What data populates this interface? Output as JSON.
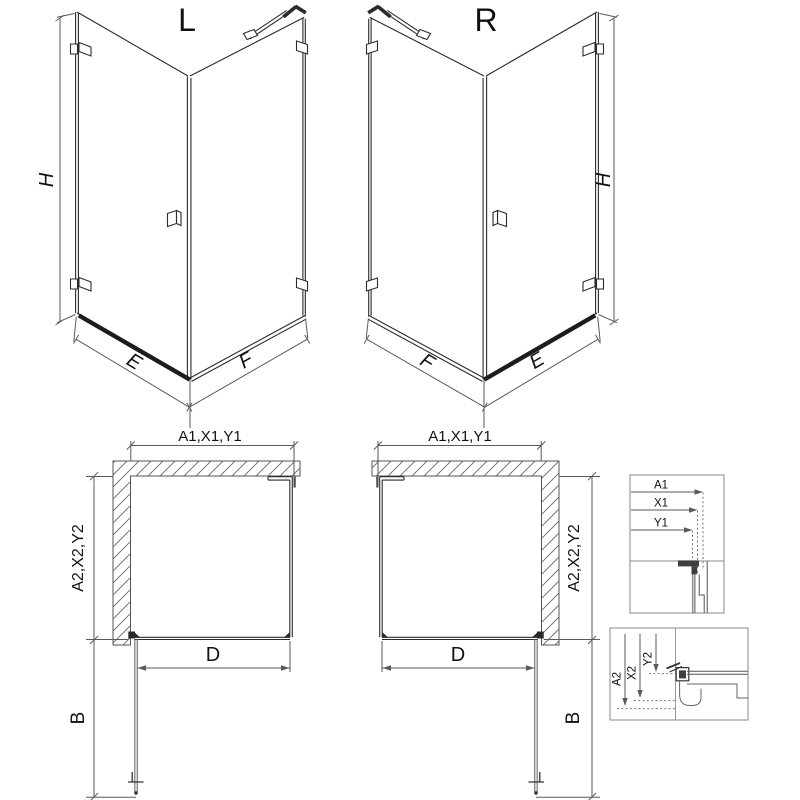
{
  "colors": {
    "line": "#2b2b2b",
    "dim": "#5a5a5a",
    "text": "#111111",
    "background": "#ffffff"
  },
  "views": {
    "left3d": {
      "label": "L",
      "height_dim": "H",
      "door_width_dim": "E",
      "panel_width_dim": "F"
    },
    "right3d": {
      "label": "R",
      "height_dim": "H",
      "door_width_dim": "E",
      "panel_width_dim": "F"
    },
    "planL": {
      "width_dim": "A1,X1,Y1",
      "depth_dim": "A2,X2,Y2",
      "door_dim": "D",
      "swing_dim": "B"
    },
    "planR": {
      "width_dim": "A1,X1,Y1",
      "depth_dim": "A2,X2,Y2",
      "door_dim": "D",
      "swing_dim": "B"
    },
    "detailTop": {
      "a1": "A1",
      "x1": "X1",
      "y1": "Y1"
    },
    "detailBottom": {
      "a2": "A2",
      "x2": "X2",
      "y2": "Y2"
    }
  }
}
